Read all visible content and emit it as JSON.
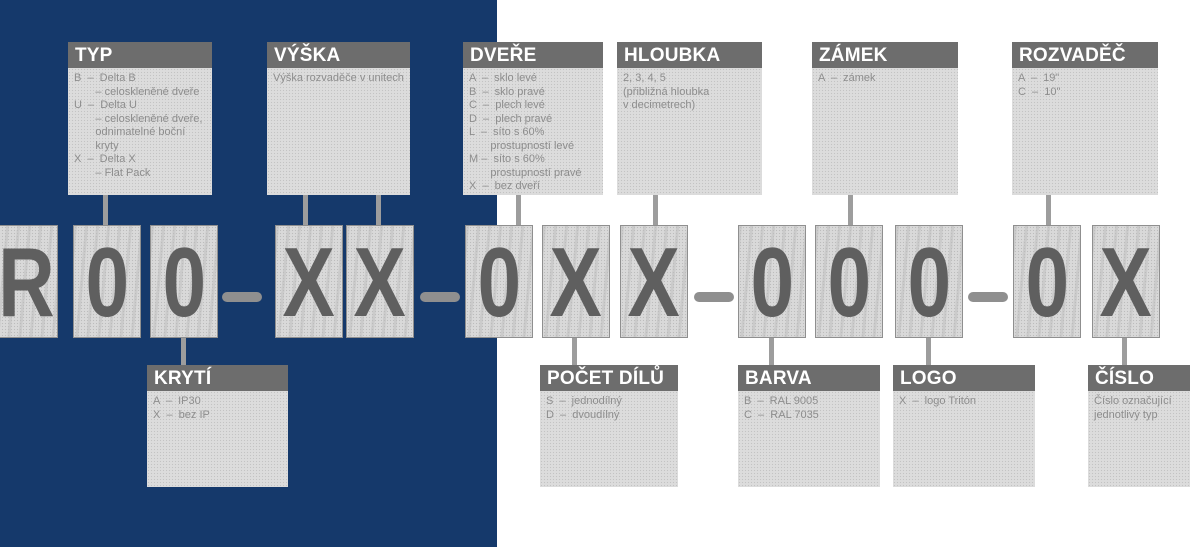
{
  "colors": {
    "navy_background": "#15396b",
    "box_header_gray": "#6d6d6d",
    "box_body_gray": "#dcdcdc",
    "body_text_gray": "#8d8d8d",
    "code_letter_gray": "#5f5f5f",
    "connector_gray": "#9d9d9d"
  },
  "code": {
    "full": "R00-XX-0XX-000-0X",
    "cells": [
      "R",
      "0",
      "0",
      "X",
      "X",
      "0",
      "X",
      "X",
      "0",
      "0",
      "0",
      "0",
      "X"
    ]
  },
  "boxes": {
    "typ": {
      "title": "TYP",
      "lines": [
        "B  –  Delta B",
        "       – celoskleněné dveře",
        "U  –  Delta U",
        "       – celoskleněné dveře,",
        "       odnimatelné boční",
        "       kryty",
        "X  –  Delta X",
        "       – Flat Pack"
      ]
    },
    "vyska": {
      "title": "VÝŠKA",
      "lines": [
        "Výška rozvaděče v unitech"
      ]
    },
    "dvere": {
      "title": "DVEŘE",
      "lines": [
        "A  –  sklo levé",
        "B  –  sklo pravé",
        "C  –  plech levé",
        "D  –  plech pravé",
        "L  –  síto s 60%",
        "       prostupností levé",
        "M –  síto s 60%",
        "       prostupností pravé",
        "X  –  bez dveří"
      ]
    },
    "hloubka": {
      "title": "HLOUBKA",
      "lines": [
        "2, 3, 4, 5",
        "(přibližná hloubka",
        "v decimetrech)"
      ]
    },
    "zamek": {
      "title": "ZÁMEK",
      "lines": [
        "A  –  zámek"
      ]
    },
    "rozvadec": {
      "title": "ROZVADĚČ",
      "lines": [
        "A  –  19\"",
        "C  –  10\""
      ]
    },
    "kryti": {
      "title": "KRYTÍ",
      "lines": [
        "A  –  IP30",
        "X  –  bez IP"
      ]
    },
    "pocet_dilu": {
      "title": "POČET DÍLŮ",
      "lines": [
        "S  –  jednodílný",
        "D  –  dvoudílný"
      ]
    },
    "barva": {
      "title": "BARVA",
      "lines": [
        "B  –  RAL 9005",
        "C  –  RAL 7035"
      ]
    },
    "logo": {
      "title": "LOGO",
      "lines": [
        "X  –  logo Tritón"
      ]
    },
    "cislo": {
      "title": "ČÍSLO",
      "lines": [
        "Číslo označující",
        "jednotlivý typ"
      ]
    }
  }
}
